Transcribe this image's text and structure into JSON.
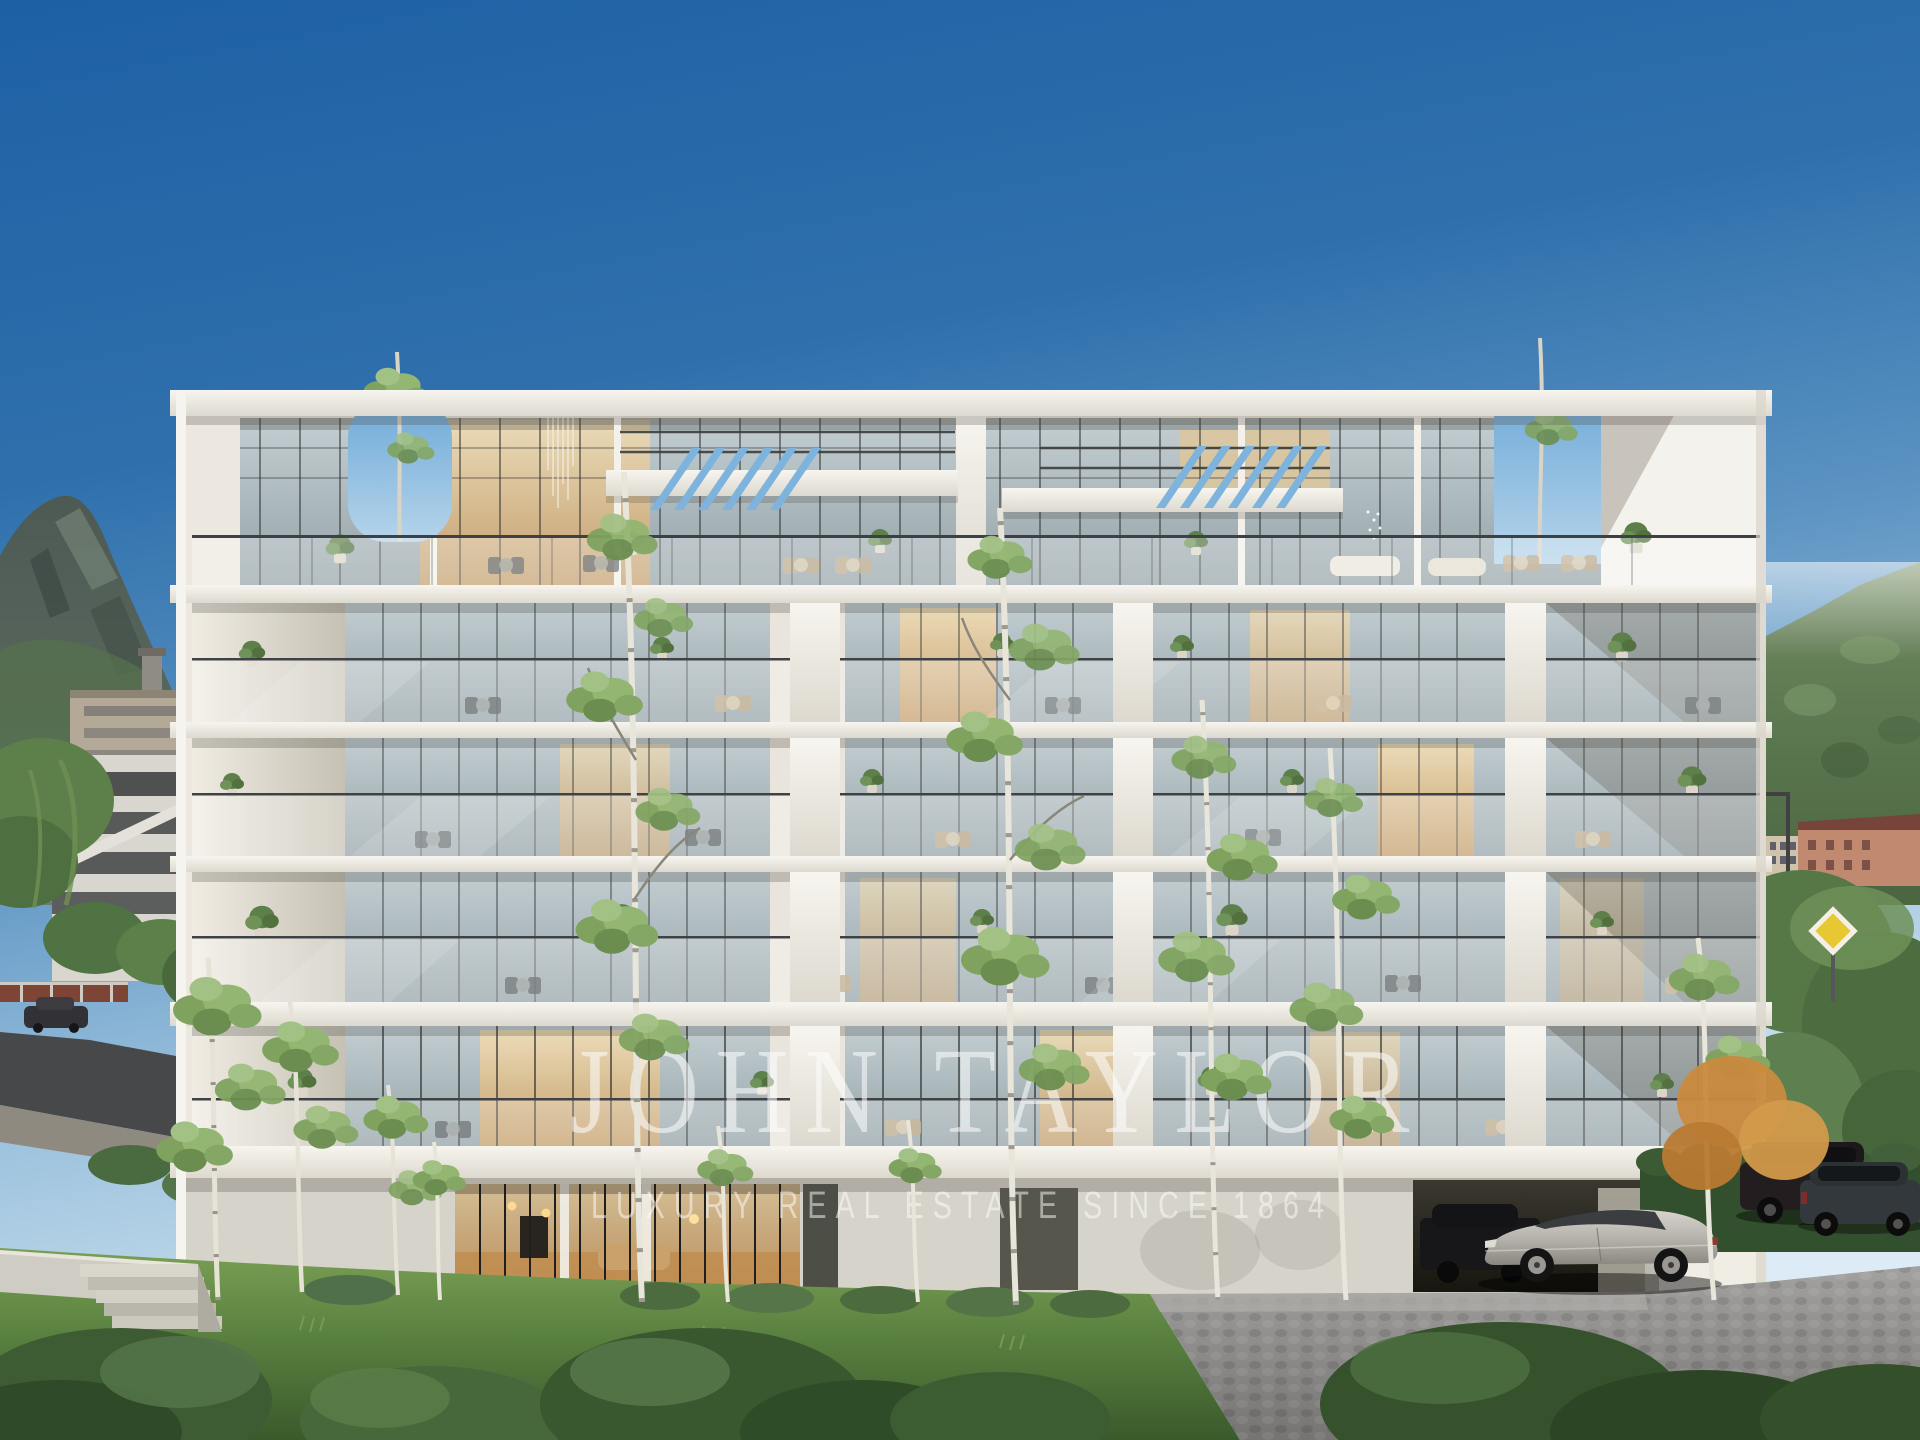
{
  "image": {
    "type": "architectural rendering photograph",
    "subject": "modern white 6-storey luxury apartment building with glass balconies",
    "setting": "alpine valley town on a clear blue-sky day, mountains on both sides, birch trees and lawn in foreground, cobbled driveway with parked cars at right"
  },
  "watermark": {
    "brand": "JOHN TAYLOR",
    "tagline": "LUXURY REAL ESTATE SINCE 1864",
    "color": "#ffffff"
  },
  "palette": {
    "sky_top": "#1d60a4",
    "sky_horizon": "#c9dfee",
    "facade_white": "#ece8e0",
    "slab_light": "#f7f5ef",
    "glass_blue": "#a8b6bb",
    "interior_warm": "#d9b77f",
    "mountain_left": "#4d5a54",
    "mountain_right": "#5b7750",
    "lawn_green": "#5a8140",
    "cobble_gray": "#8f8e8c",
    "car_silver": "#b3b0aa",
    "hedge_dark_green": "#33502e",
    "road_sign_yellow": "#e8c832"
  },
  "scene": {
    "building": {
      "floors_visible": 6,
      "top_level": "double-height penthouse terraces with slatted pergola openings and corner roof cut-outs with trees",
      "mid_levels": "four balcony floors with glass balustrades, potted plants and outdoor furniture",
      "ground_level": "warm-lit lobby behind glazing, dark garage opening at right"
    },
    "vehicles": [
      "silver coupe sedan parked on cobbles facing left",
      "black SUV inside garage",
      "dark SUV behind hedge",
      "grey estate car at far right"
    ],
    "vegetation": [
      "slender birch trees in front of facade",
      "dense shrubs along bottom edge",
      "autumn-orange tree near right corner",
      "weeping green tree at far left"
    ],
    "landmarks": [
      "rocky mountain ridge at left",
      "forested mountain slope at right",
      "white parking structure and town buildings at left",
      "salmon apartment blocks at right",
      "yellow diamond road sign",
      "concrete stair and retaining wall at lower left"
    ]
  }
}
